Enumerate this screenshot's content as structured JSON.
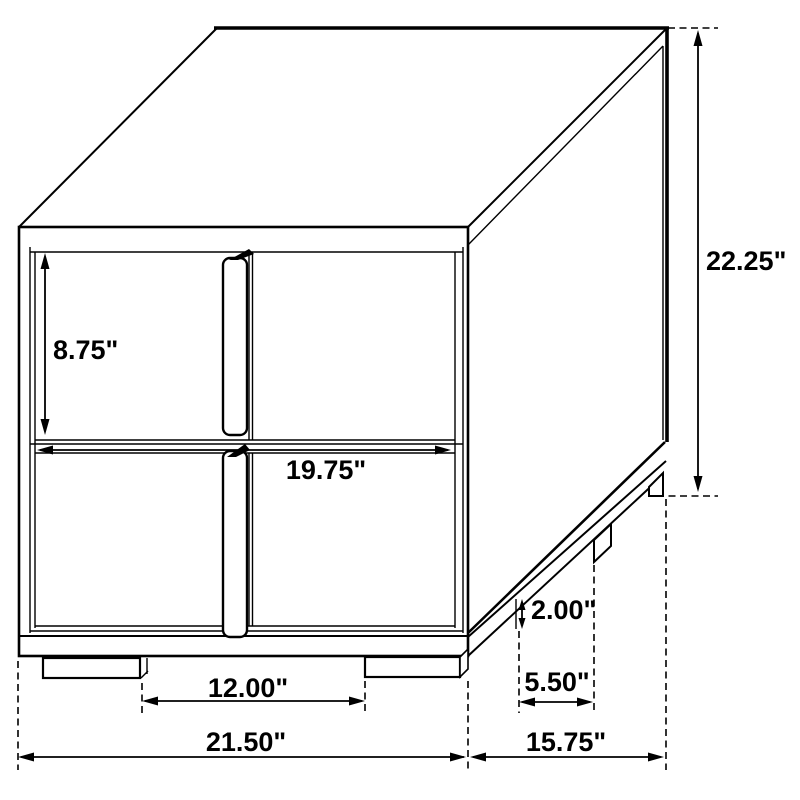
{
  "diagram": {
    "type": "furniture-dimension-drawing",
    "subject": "2-drawer nightstand isometric line drawing with dimensions",
    "unit": "inches",
    "labels": {
      "drawer_height": "8.75\"",
      "drawer_width": "19.75\"",
      "overall_height": "22.25\"",
      "base_height": "2.00\"",
      "side_leg_spacing": "5.50\"",
      "front_leg_spacing": "12.00\"",
      "overall_width": "21.50\"",
      "overall_depth": "15.75\""
    },
    "colors": {
      "line": "#000000",
      "background": "#ffffff",
      "text": "#000000"
    }
  }
}
